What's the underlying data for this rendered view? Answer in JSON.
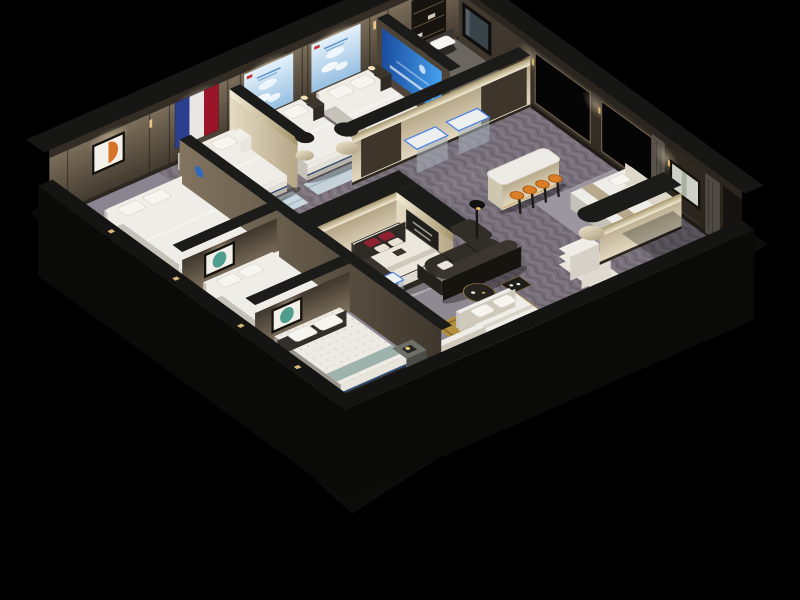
{
  "scene": {
    "type": "isometric-3d-cutaway-render",
    "description": "Isometric cutaway 3D render of a mattress and bedding showroom on a black background: bedroom display bays with white beds, a French flag wall hanging, sky-blue posters, abstract artworks, a corner room with blue brand banner and dark bed, central island bed with red pillows, white bar counter with orange stools, curved dark leather sofa, LED display vitrines, herringbone floor and beds cut by the open walls",
    "background_color": "#000000"
  },
  "colors": {
    "background": "#000000",
    "flag_blue": "#2c3f8f",
    "flag_white": "#e9e7e3",
    "flag_red": "#9b1528",
    "poster_sky": "#bcd9ee",
    "banner_blue": "#2f7fd6",
    "stool_orange": "#d97d26",
    "sofa_dark": "#312d27",
    "led_blue": "#4a7fe8",
    "art_orange": "#d8732a",
    "art_teal": "#4f9d8c",
    "rug_gold": "#b29040",
    "pillow_red": "#8e2230",
    "bed_navy": "#2c4a72",
    "mattress_white": "#efede7",
    "partition_cream": "#d8cdb2",
    "wall_tan": "#6e6252",
    "wall_top_dark": "#1b1b19",
    "floor_herringbone": "#776f79",
    "carpet_gray": "#8b8590"
  },
  "rooms": [
    {
      "name": "bedroom-display-orange-art",
      "wall_art": "orange abstract painting",
      "furniture": [
        "large cream double bed"
      ]
    },
    {
      "name": "bedroom-display-french-flag",
      "wall_art": "french flag fabric panels (blue, white, red)",
      "furniture": [
        "white layered bed",
        "white mini cabinet",
        "nightstand"
      ]
    },
    {
      "name": "bedroom-display-sky-poster-1",
      "wall_art": "light blue sky poster with clouds and red logo",
      "furniture": [
        "white bed",
        "nightstand with lamp",
        "pale blue rug"
      ]
    },
    {
      "name": "bedroom-display-sky-poster-2",
      "wall_art": "light blue sky poster with clouds and red logo",
      "furniture": [
        "white bed",
        "nightstand with lamp",
        "pale blue rug"
      ]
    },
    {
      "name": "corner-bedroom-display",
      "wall_art": "blue vertical brand banner",
      "furniture": [
        "dark grey bed with white pillows",
        "wall tv",
        "dark shelving unit",
        "grey rug"
      ]
    },
    {
      "name": "bedroom-display-teal-art-1",
      "wall_art": "teal abstract painting",
      "furniture": [
        "white bed",
        "foot bench"
      ]
    },
    {
      "name": "bedroom-display-teal-art-2",
      "wall_art": "teal abstract painting",
      "furniture": [
        "white tufted mattress bed with navy base",
        "grey side table with candle"
      ]
    },
    {
      "name": "central-hall",
      "furniture": [
        "island bed with red pillows",
        "curved cream partition walls with dark tops",
        "glass vitrines with blue led edges",
        "white bar counter",
        "four orange bar stools",
        "curved dark leather sofa",
        "round coffee table",
        "black side table",
        "floor lamp",
        "mattress step display",
        "two beds on gold rug",
        "bed niche behind curved partition"
      ]
    }
  ],
  "wall_features": {
    "ne_wall": [
      "dark door niche",
      "wall tv",
      "recessed black display panel",
      "recessed black display panel",
      "grey curtain",
      "framed landscape artwork",
      "grey curtain",
      "gold wall sconces"
    ],
    "sw_edge": [
      "tiny gold accent lights on cut wall top"
    ]
  }
}
